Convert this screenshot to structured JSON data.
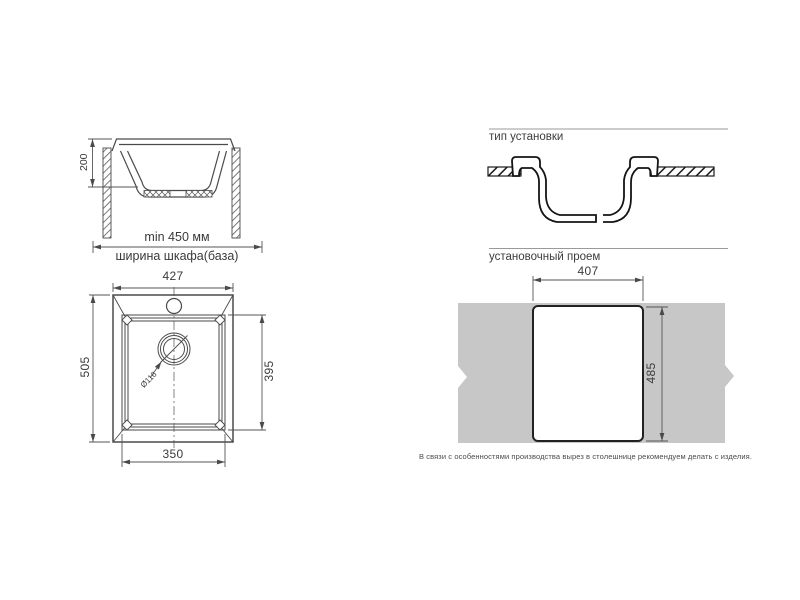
{
  "colors": {
    "countertop": "#c7c7c7",
    "line": "#4a4a4a",
    "profile": "#141414",
    "text": "#3a3a3a"
  },
  "cabinet_section": {
    "depth": "200",
    "min_width": "min 450 мм",
    "cabinet_width": "ширина шкафа(база)"
  },
  "mounting": {
    "title": "тип установки"
  },
  "plan": {
    "overall_width": "427",
    "overall_depth": "505",
    "bowl_depth": "395",
    "bowl_width": "350",
    "drain_diameter": "Ø116"
  },
  "cutout": {
    "title": "установочный проем",
    "width": "407",
    "height": "485",
    "note": "В связи с особенностями производства вырез в столешнице рекомендуем делать с изделия."
  }
}
